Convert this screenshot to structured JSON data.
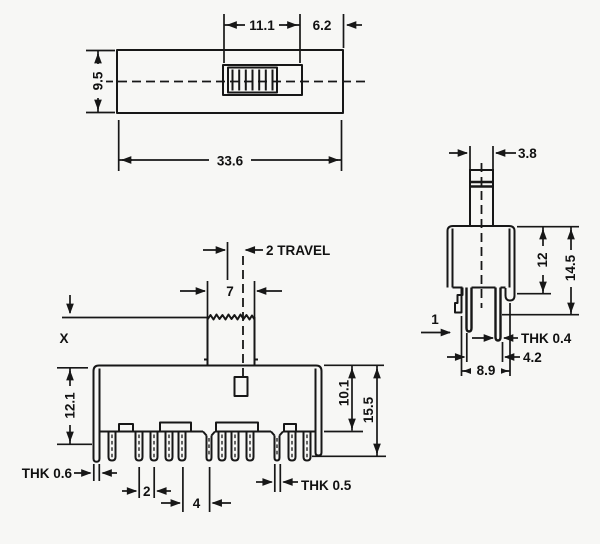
{
  "drawing": {
    "top_view": {
      "opening_width": "11.1",
      "knob_offset": "6.2",
      "body_depth": "9.5",
      "overall_length": "33.6"
    },
    "front_view": {
      "travel": "2 TRAVEL",
      "knob_width": "7",
      "knob_height": "X",
      "body_to_pin_tip": "12.1",
      "body_height": "10.1",
      "overall_height": "15.5",
      "leg_thickness": "THK 0.6",
      "pin_pitch": "2",
      "group_pitch": "4",
      "pin_thickness": "THK 0.5"
    },
    "side_view": {
      "shaft_width": "3.8",
      "body_height": "12",
      "overall_height": "14.5",
      "step_width": "1",
      "terminal_thickness": "THK 0.4",
      "terminal_span": "4.2",
      "body_width": "8.9"
    }
  }
}
